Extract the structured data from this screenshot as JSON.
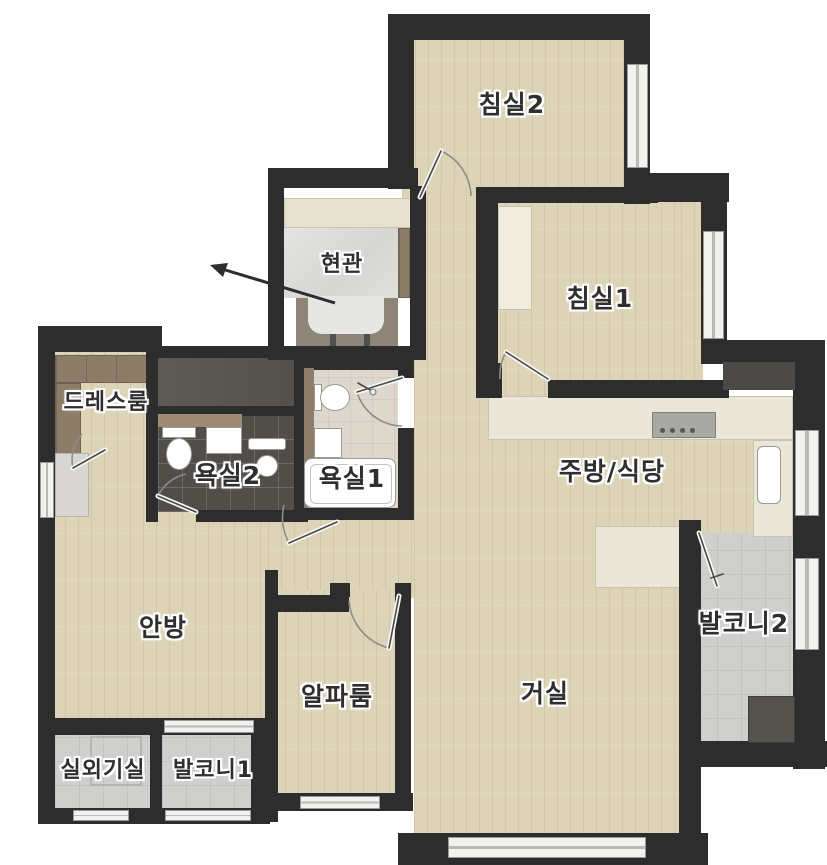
{
  "floorplan": {
    "title": "아파트 평면도",
    "rooms": {
      "bedroom2": {
        "label": "침실2"
      },
      "entrance": {
        "label": "현관"
      },
      "bedroom1": {
        "label": "침실1"
      },
      "dressroom": {
        "label": "드레스룸"
      },
      "bathroom2": {
        "label": "욕실2"
      },
      "bathroom1": {
        "label": "욕실1"
      },
      "kitchen_dining": {
        "label": "주방/식당"
      },
      "master_bedroom": {
        "label": "안방"
      },
      "alpha_room": {
        "label": "알파룸"
      },
      "living_room": {
        "label": "거실"
      },
      "balcony2": {
        "label": "발코니2"
      },
      "outdoor_unit_room": {
        "label": "실외기실"
      },
      "balcony1": {
        "label": "발코니1"
      }
    },
    "palette": {
      "wall": "#2d2d2d",
      "wood_floor": "#ddd4b8",
      "entrance_marble": "#dcdcda",
      "bath2_dark_tile": "#514d48",
      "bath1_light_tile": "#ddd7cc",
      "balcony_tile": "#d2d3d1",
      "kitchen_counter": "#eae6d8",
      "cabinet_brown": "#8d7c68",
      "fixture_white": "#ffffff",
      "utility_gray": "#58544e",
      "outside": "#ffffff"
    }
  }
}
